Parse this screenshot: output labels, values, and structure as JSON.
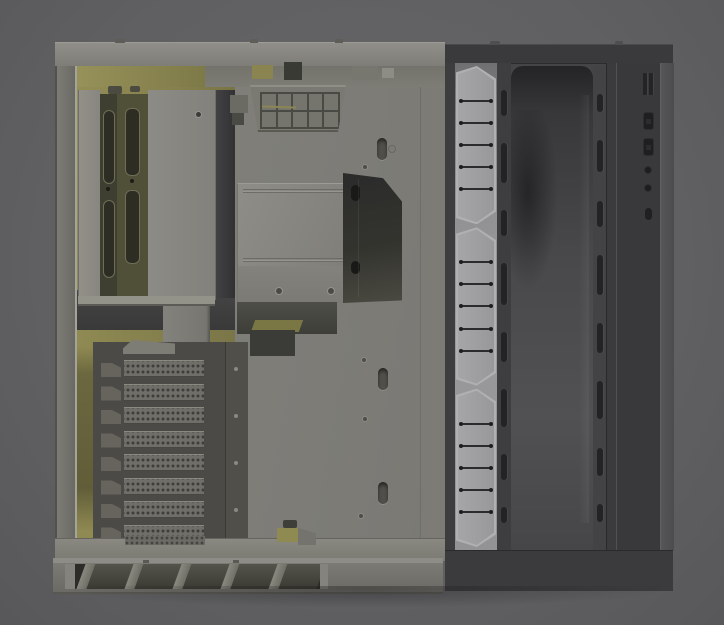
{
  "scene": {
    "type": "3d-render",
    "subject": "Open PC case chassis side view with detached front fan-bracket panel",
    "background": "#606062"
  },
  "colors": {
    "bg": "#606062",
    "frame": "#84837d",
    "tray": "#7e7d78",
    "yellow": "#938e55",
    "panel-body": "#454547",
    "strip": "#9a9a9c",
    "slot": "#232325",
    "pci-cover": "#6f6e68"
  },
  "chassis": {
    "name": "case-chassis-side",
    "top_vent_grid": {
      "rows": 2,
      "cols": 5
    },
    "rear_bracket": {
      "slot_rails": 2,
      "slots_per_rail": 2
    },
    "pci_slots": {
      "count": 8
    },
    "cable_cutouts": {
      "count": 3
    },
    "base_slats": {
      "count": 5
    },
    "screw_holes": {
      "count": 4
    }
  },
  "front_panel": {
    "name": "front-panel-fan-bracket",
    "fan_brackets": {
      "sections": 3,
      "rungs_per_section": 5
    },
    "vent_slot_columns": {
      "left": 8,
      "right": 8
    },
    "io_ports": {
      "vent_lines": 2,
      "usb_ports": 2,
      "audio_jacks": 2,
      "indicators": 1
    }
  }
}
